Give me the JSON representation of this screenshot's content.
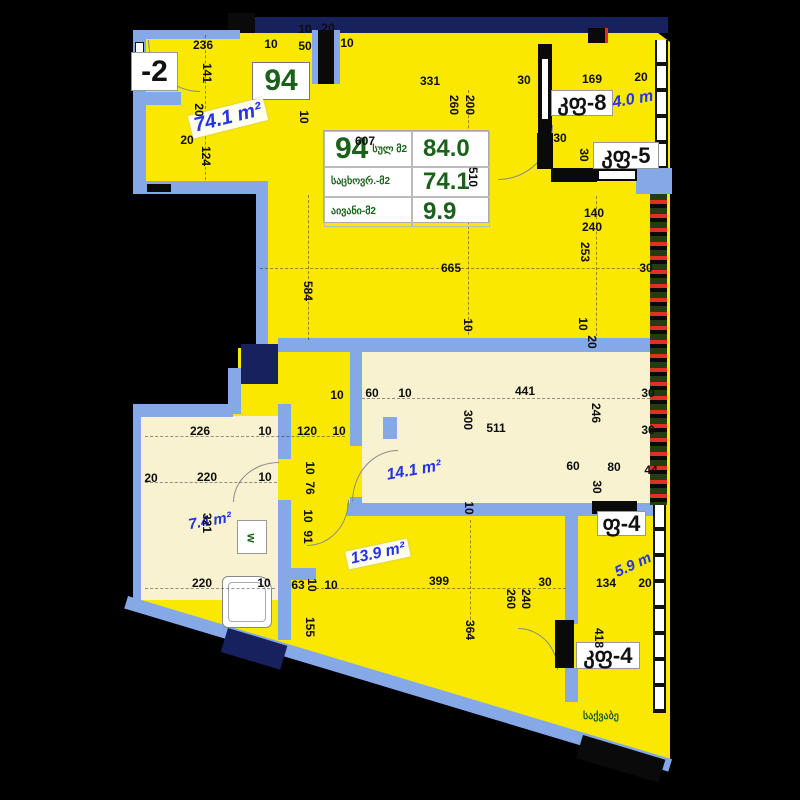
{
  "apartment": {
    "number": "94",
    "title_block": {
      "total_label": "სულ მ2",
      "total_value": "84.0",
      "living_label": "საცხოვრ.-მ2",
      "living_value": "74.1",
      "balcony_label": "აივანი-მ2",
      "balcony_value": "9.9"
    }
  },
  "colors": {
    "plan_yellow": "#fae800",
    "room_cream": "#f8f2d0",
    "wall_blue": "#85a9e6",
    "column_navy": "#17215e",
    "value_green": "#1a611a",
    "area_blue": "#2433ea",
    "railing_red": "#e03020"
  },
  "room_tags": [
    {
      "text": "-2",
      "x": 131,
      "y": 52,
      "w": 47,
      "h": 39,
      "fs": 30,
      "green": false
    },
    {
      "text": "94",
      "x": 252,
      "y": 62,
      "w": 58,
      "h": 38,
      "fs": 30,
      "green": true
    },
    {
      "text": "კფ-8",
      "x": 551,
      "y": 90,
      "w": 62,
      "h": 26,
      "fs": 22,
      "green": false
    },
    {
      "text": "კფ-5",
      "x": 593,
      "y": 142,
      "w": 66,
      "h": 27,
      "fs": 22,
      "green": false
    },
    {
      "text": "ფ-4",
      "x": 597,
      "y": 511,
      "w": 49,
      "h": 25,
      "fs": 22,
      "green": false
    },
    {
      "text": "კფ-4",
      "x": 576,
      "y": 642,
      "w": 64,
      "h": 27,
      "fs": 22,
      "green": false
    }
  ],
  "area_labels": [
    {
      "text": "74.1 m²",
      "x": 228,
      "y": 118,
      "rot": -14,
      "fs": 20,
      "bg": true
    },
    {
      "text": "4.0 m",
      "x": 633,
      "y": 100,
      "rot": -10,
      "fs": 16,
      "bg": false
    },
    {
      "text": "14.1 m²",
      "x": 414,
      "y": 471,
      "rot": -10,
      "fs": 16,
      "bg": false
    },
    {
      "text": "7.4 m²",
      "x": 210,
      "y": 521,
      "rot": -10,
      "fs": 15,
      "bg": false
    },
    {
      "text": "13.9 m²",
      "x": 378,
      "y": 554,
      "rot": -12,
      "fs": 16,
      "bg": true
    },
    {
      "text": "5.9 m",
      "x": 633,
      "y": 565,
      "rot": -25,
      "fs": 15,
      "bg": false
    }
  ],
  "misc_text": {
    "boiler": "საქვაბე",
    "washer": "w"
  },
  "dimensions": [
    {
      "t": "236",
      "x": 203,
      "y": 45,
      "r": 0
    },
    {
      "t": "141",
      "x": 207,
      "y": 73,
      "r": 90
    },
    {
      "t": "10",
      "x": 271,
      "y": 44,
      "r": 0
    },
    {
      "t": "50",
      "x": 305,
      "y": 46,
      "r": 0
    },
    {
      "t": "10",
      "x": 347,
      "y": 43,
      "r": 0
    },
    {
      "t": "10",
      "x": 305,
      "y": 29,
      "r": 0
    },
    {
      "t": "20",
      "x": 328,
      "y": 28,
      "r": 0
    },
    {
      "t": "20",
      "x": 187,
      "y": 140,
      "r": 0
    },
    {
      "t": "20",
      "x": 199,
      "y": 110,
      "r": 90
    },
    {
      "t": "124",
      "x": 206,
      "y": 156,
      "r": 90
    },
    {
      "t": "331",
      "x": 430,
      "y": 81,
      "r": 0
    },
    {
      "t": "30",
      "x": 524,
      "y": 80,
      "r": 0
    },
    {
      "t": "169",
      "x": 592,
      "y": 79,
      "r": 0
    },
    {
      "t": "20",
      "x": 641,
      "y": 77,
      "r": 0
    },
    {
      "t": "260",
      "x": 454,
      "y": 105,
      "r": 90
    },
    {
      "t": "200",
      "x": 470,
      "y": 105,
      "r": 90
    },
    {
      "t": "10",
      "x": 304,
      "y": 117,
      "r": 90
    },
    {
      "t": "607",
      "x": 365,
      "y": 141,
      "r": 0
    },
    {
      "t": "510",
      "x": 473,
      "y": 177,
      "r": 90
    },
    {
      "t": "30",
      "x": 560,
      "y": 138,
      "r": 0
    },
    {
      "t": "30",
      "x": 584,
      "y": 155,
      "r": 90
    },
    {
      "t": "140",
      "x": 594,
      "y": 213,
      "r": 0
    },
    {
      "t": "240",
      "x": 592,
      "y": 227,
      "r": 0
    },
    {
      "t": "253",
      "x": 585,
      "y": 252,
      "r": 90
    },
    {
      "t": "30",
      "x": 646,
      "y": 268,
      "r": 0
    },
    {
      "t": "10",
      "x": 583,
      "y": 324,
      "r": 90
    },
    {
      "t": "20",
      "x": 592,
      "y": 342,
      "r": 90
    },
    {
      "t": "584",
      "x": 308,
      "y": 291,
      "r": 90
    },
    {
      "t": "665",
      "x": 451,
      "y": 268,
      "r": 0
    },
    {
      "t": "10",
      "x": 468,
      "y": 325,
      "r": 90
    },
    {
      "t": "60",
      "x": 372,
      "y": 393,
      "r": 0
    },
    {
      "t": "10",
      "x": 405,
      "y": 393,
      "r": 0
    },
    {
      "t": "441",
      "x": 525,
      "y": 391,
      "r": 0
    },
    {
      "t": "10",
      "x": 337,
      "y": 395,
      "r": 0
    },
    {
      "t": "300",
      "x": 468,
      "y": 420,
      "r": 90
    },
    {
      "t": "511",
      "x": 496,
      "y": 428,
      "r": 0
    },
    {
      "t": "246",
      "x": 596,
      "y": 413,
      "r": 90
    },
    {
      "t": "30",
      "x": 648,
      "y": 393,
      "r": 0
    },
    {
      "t": "30",
      "x": 648,
      "y": 430,
      "r": 0
    },
    {
      "t": "60",
      "x": 573,
      "y": 466,
      "r": 0
    },
    {
      "t": "80",
      "x": 614,
      "y": 467,
      "r": 0
    },
    {
      "t": "44",
      "x": 651,
      "y": 470,
      "r": 0
    },
    {
      "t": "30",
      "x": 597,
      "y": 487,
      "r": 90
    },
    {
      "t": "10",
      "x": 469,
      "y": 508,
      "r": 90
    },
    {
      "t": "226",
      "x": 200,
      "y": 431,
      "r": 0
    },
    {
      "t": "10",
      "x": 265,
      "y": 431,
      "r": 0
    },
    {
      "t": "120",
      "x": 307,
      "y": 431,
      "r": 0
    },
    {
      "t": "10",
      "x": 339,
      "y": 431,
      "r": 0
    },
    {
      "t": "20",
      "x": 151,
      "y": 478,
      "r": 0
    },
    {
      "t": "220",
      "x": 207,
      "y": 477,
      "r": 0
    },
    {
      "t": "10",
      "x": 265,
      "y": 477,
      "r": 0
    },
    {
      "t": "10",
      "x": 310,
      "y": 468,
      "r": 90
    },
    {
      "t": "76",
      "x": 310,
      "y": 488,
      "r": 90
    },
    {
      "t": "10",
      "x": 308,
      "y": 516,
      "r": 90
    },
    {
      "t": "91",
      "x": 308,
      "y": 537,
      "r": 90
    },
    {
      "t": "321",
      "x": 207,
      "y": 523,
      "r": 90
    },
    {
      "t": "220",
      "x": 202,
      "y": 583,
      "r": 0
    },
    {
      "t": "10",
      "x": 264,
      "y": 583,
      "r": 0
    },
    {
      "t": "63",
      "x": 298,
      "y": 585,
      "r": 0
    },
    {
      "t": "10",
      "x": 312,
      "y": 585,
      "r": 90
    },
    {
      "t": "10",
      "x": 331,
      "y": 585,
      "r": 0
    },
    {
      "t": "155",
      "x": 310,
      "y": 627,
      "r": 90
    },
    {
      "t": "399",
      "x": 439,
      "y": 581,
      "r": 0
    },
    {
      "t": "30",
      "x": 545,
      "y": 582,
      "r": 0
    },
    {
      "t": "364",
      "x": 470,
      "y": 630,
      "r": 90
    },
    {
      "t": "260",
      "x": 511,
      "y": 599,
      "r": 90
    },
    {
      "t": "240",
      "x": 526,
      "y": 599,
      "r": 90
    },
    {
      "t": "134",
      "x": 606,
      "y": 583,
      "r": 0
    },
    {
      "t": "20",
      "x": 645,
      "y": 583,
      "r": 0
    },
    {
      "t": "418",
      "x": 599,
      "y": 638,
      "r": 90
    }
  ]
}
